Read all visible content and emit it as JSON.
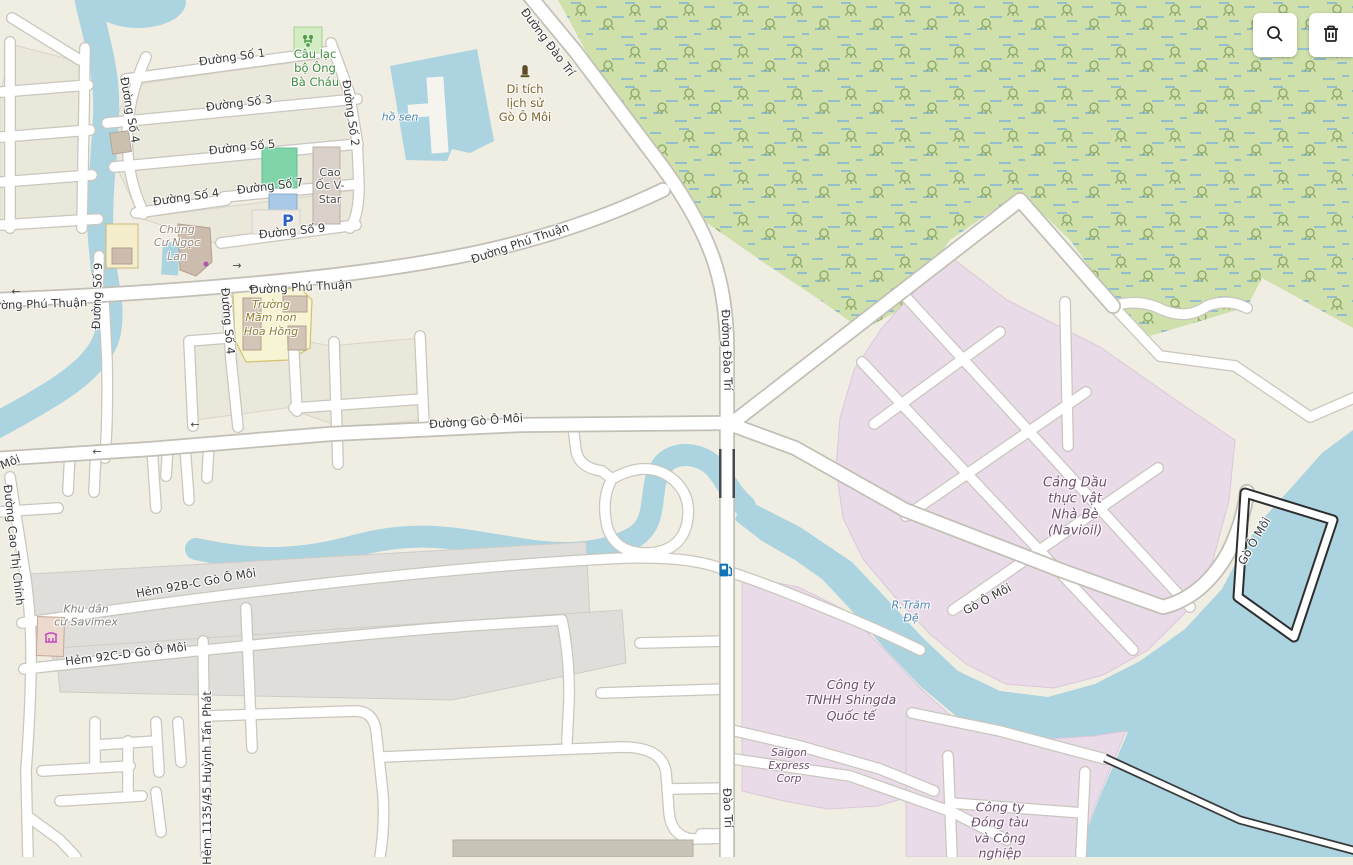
{
  "app": {
    "title": "Map viewer with OpenStreetMap-style map of Phú Thuận / Nhà Bè area"
  },
  "toolbar": {
    "buttons": [
      {
        "name": "search",
        "icon": "magnifier-icon"
      },
      {
        "name": "delete",
        "icon": "trash-icon"
      }
    ]
  },
  "palette": {
    "land": "#f0ede3",
    "water": "#abd4e0",
    "wetland": "#cfe0ab",
    "industrial": "#eadbe8",
    "residential": "#e0dedb",
    "school": "#f7f4d3",
    "building": "#d9d0c9",
    "road_fill": "#ffffff",
    "road_casing": "#c9c6be",
    "road_label": "#383838",
    "water_label": "#4d87b5",
    "industrial_label": "#6e4d6b",
    "historic_label": "#7d6029",
    "leisure_label": "#3d8b3d",
    "parking_blue": "#2a63c8",
    "fuel_blue": "#1273b8",
    "attraction_magenta": "#c24ac2"
  },
  "map": {
    "labels": [
      {
        "name": "road-label-duong-so-1",
        "text": "Đường Số 1",
        "x": 232,
        "y": 57,
        "rot": -8,
        "style": "road"
      },
      {
        "name": "poi-label-cau-lac-bo-ong-ba-chau",
        "text": "Câu lạc\nbộ Ông\nBà Cháu",
        "x": 315,
        "y": 68,
        "rot": 0,
        "style": "poi-green"
      },
      {
        "name": "road-label-duong-so-3",
        "text": "Đường Số 3",
        "x": 239,
        "y": 103,
        "rot": -7,
        "style": "road"
      },
      {
        "name": "road-label-duong-so-2",
        "text": "Đường Số 2",
        "x": 351,
        "y": 113,
        "rot": 82,
        "style": "road"
      },
      {
        "name": "water-label-ho-sen",
        "text": "hồ sen",
        "x": 400,
        "y": 117,
        "rot": 0,
        "style": "water"
      },
      {
        "name": "road-label-duong-so-5",
        "text": "Đường Số 5",
        "x": 242,
        "y": 147,
        "rot": -6,
        "style": "road"
      },
      {
        "name": "road-label-duong-so-4-nw",
        "text": "Đường Số 4",
        "x": 130,
        "y": 110,
        "rot": 80,
        "style": "road"
      },
      {
        "name": "road-label-duong-so-7",
        "text": "Đường Số 7",
        "x": 270,
        "y": 186,
        "rot": -7,
        "style": "road"
      },
      {
        "name": "road-label-duong-so-4-h",
        "text": "Đường Số 4",
        "x": 186,
        "y": 197,
        "rot": -8,
        "style": "road"
      },
      {
        "name": "poi-label-cao-oc-v-star",
        "text": "Cao\nỐc V-\nStar",
        "x": 330,
        "y": 186,
        "rot": 0,
        "style": "poi-darkgray"
      },
      {
        "name": "road-label-duong-so-9-h",
        "text": "Đường Số 9",
        "x": 292,
        "y": 231,
        "rot": -6,
        "style": "road"
      },
      {
        "name": "poi-label-chung-cu-ngoc-lan",
        "text": "Chung\nCư Ngọc\nLan",
        "x": 177,
        "y": 243,
        "rot": 0,
        "style": "poi-tan"
      },
      {
        "name": "road-label-duong-phu-thuan-w",
        "text": "Đường Phú Thuận",
        "x": 36,
        "y": 304,
        "rot": -2,
        "style": "road"
      },
      {
        "name": "road-label-duong-so-9-v",
        "text": "Đường Số 9",
        "x": 97,
        "y": 296,
        "rot": -88,
        "style": "road"
      },
      {
        "name": "road-label-duong-phu-thuan-m",
        "text": "Đường Phú Thuận",
        "x": 301,
        "y": 287,
        "rot": -3,
        "style": "road"
      },
      {
        "name": "poi-label-truong-mam-non-hoa-hong",
        "text": "Trường\nMầm non\nHoa Hồng",
        "x": 271,
        "y": 318,
        "rot": 0,
        "style": "poi-olive"
      },
      {
        "name": "road-label-duong-so-4-v",
        "text": "Đường Số 4",
        "x": 228,
        "y": 321,
        "rot": 85,
        "style": "road"
      },
      {
        "name": "road-label-duong-phu-thuan-e",
        "text": "Đường Phú Thuận",
        "x": 520,
        "y": 243,
        "rot": -19,
        "style": "road"
      },
      {
        "name": "road-label-duong-dao-tri-n",
        "text": "Đường Đào Trí",
        "x": 548,
        "y": 42,
        "rot": 53,
        "style": "road"
      },
      {
        "name": "poi-label-di-tich-go-o-moi",
        "text": "Di tích\nlịch sử\nGò Ô Môi",
        "x": 525,
        "y": 103,
        "rot": 0,
        "style": "poi-brown"
      },
      {
        "name": "road-label-duong-dao-tri-m",
        "text": "Đường Đào Trí",
        "x": 727,
        "y": 350,
        "rot": 88,
        "style": "road"
      },
      {
        "name": "road-label-duong-go-o-moi",
        "text": "Đường Gò Ô Môi",
        "x": 476,
        "y": 421,
        "rot": -4,
        "style": "road"
      },
      {
        "name": "road-label-moi-w",
        "text": "Môi",
        "x": 10,
        "y": 462,
        "rot": -22,
        "style": "road"
      },
      {
        "name": "road-label-duong-cao-thi-chinh",
        "text": "Đường Cao Thị Chính",
        "x": 14,
        "y": 545,
        "rot": 84,
        "style": "road"
      },
      {
        "name": "poi-label-navioil",
        "text": "Cảng Dầu\nthực vật\nNhà Bè\n(Navioil)",
        "x": 1075,
        "y": 507,
        "rot": 0,
        "style": "navioil"
      },
      {
        "name": "road-label-go-o-moi-1",
        "text": "Gò Ô Môi",
        "x": 987,
        "y": 599,
        "rot": -28,
        "style": "road"
      },
      {
        "name": "road-label-go-o-moi-2",
        "text": "Gò Ô Môi",
        "x": 1254,
        "y": 541,
        "rot": -60,
        "style": "road"
      },
      {
        "name": "water-label-r-tram-de",
        "text": "R.Trãm\nĐệ",
        "x": 911,
        "y": 612,
        "rot": 0,
        "style": "water"
      },
      {
        "name": "poi-label-shingda",
        "text": "Công ty\nTNHH Shingda\nQuốc tế",
        "x": 851,
        "y": 700,
        "rot": 0,
        "style": "poi-mauve"
      },
      {
        "name": "poi-label-saigon-express",
        "text": "Saigon\nExpress\nCorp",
        "x": 789,
        "y": 766,
        "rot": 0,
        "style": "poi-mauve-sm"
      },
      {
        "name": "poi-label-cong-ty-dong-tau",
        "text": "Công ty\nĐóng tàu\nvà Công\nnghiệp",
        "x": 1000,
        "y": 830,
        "rot": 0,
        "style": "poi-mauve"
      },
      {
        "name": "poi-label-khu-dan-cu-savimex",
        "text": "Khu dân\ncư Savimex",
        "x": 86,
        "y": 616,
        "rot": 0,
        "style": "poi-gray"
      },
      {
        "name": "road-label-hem-92bc",
        "text": "Hẻm 92B-C Gò Ô Môi",
        "x": 196,
        "y": 583,
        "rot": -10,
        "style": "road"
      },
      {
        "name": "road-label-hem-92cd",
        "text": "Hẻm 92C-D Gò Ô Môi",
        "x": 126,
        "y": 654,
        "rot": -7,
        "style": "road"
      },
      {
        "name": "road-label-hem-1135-45-huynh-tan-phat",
        "text": "Hẻm 1135/45 Huỳnh Tấn Phát",
        "x": 207,
        "y": 778,
        "rot": -90,
        "style": "road"
      },
      {
        "name": "road-label-dao-tri-s",
        "text": "Đào Trí",
        "x": 728,
        "y": 808,
        "rot": 87,
        "style": "road"
      }
    ],
    "icons": [
      {
        "name": "oneway-arrow-icon",
        "kind": "text",
        "glyph": "←",
        "x": 16,
        "y": 292,
        "rot": 0
      },
      {
        "name": "oneway-arrow-icon",
        "kind": "text",
        "glyph": "→",
        "x": 237,
        "y": 266,
        "rot": 0
      },
      {
        "name": "oneway-arrow-icon",
        "kind": "text",
        "glyph": "←",
        "x": 253,
        "y": 288,
        "rot": 0
      },
      {
        "name": "oneway-arrow-icon",
        "kind": "text",
        "glyph": "←",
        "x": 97,
        "y": 452,
        "rot": 0
      },
      {
        "name": "oneway-arrow-icon",
        "kind": "text",
        "glyph": "←",
        "x": 195,
        "y": 425,
        "rot": 0
      },
      {
        "name": "parking-icon",
        "kind": "text",
        "glyph": "P",
        "x": 288,
        "y": 221,
        "rot": 0,
        "style": "parking"
      },
      {
        "name": "monument-icon",
        "kind": "svg",
        "glyph": "monument",
        "x": 525,
        "y": 72,
        "rot": 0
      },
      {
        "name": "playground-club-icon",
        "kind": "svg",
        "glyph": "club",
        "x": 308,
        "y": 41,
        "rot": 0
      },
      {
        "name": "fuel-station-icon",
        "kind": "svg",
        "glyph": "fuel",
        "x": 726,
        "y": 570,
        "rot": 0
      },
      {
        "name": "attraction-icon",
        "kind": "svg",
        "glyph": "savimex",
        "x": 51,
        "y": 637,
        "rot": 0
      },
      {
        "name": "shop-dot-icon",
        "kind": "svg",
        "glyph": "dot",
        "x": 206,
        "y": 264,
        "rot": 0
      }
    ]
  }
}
